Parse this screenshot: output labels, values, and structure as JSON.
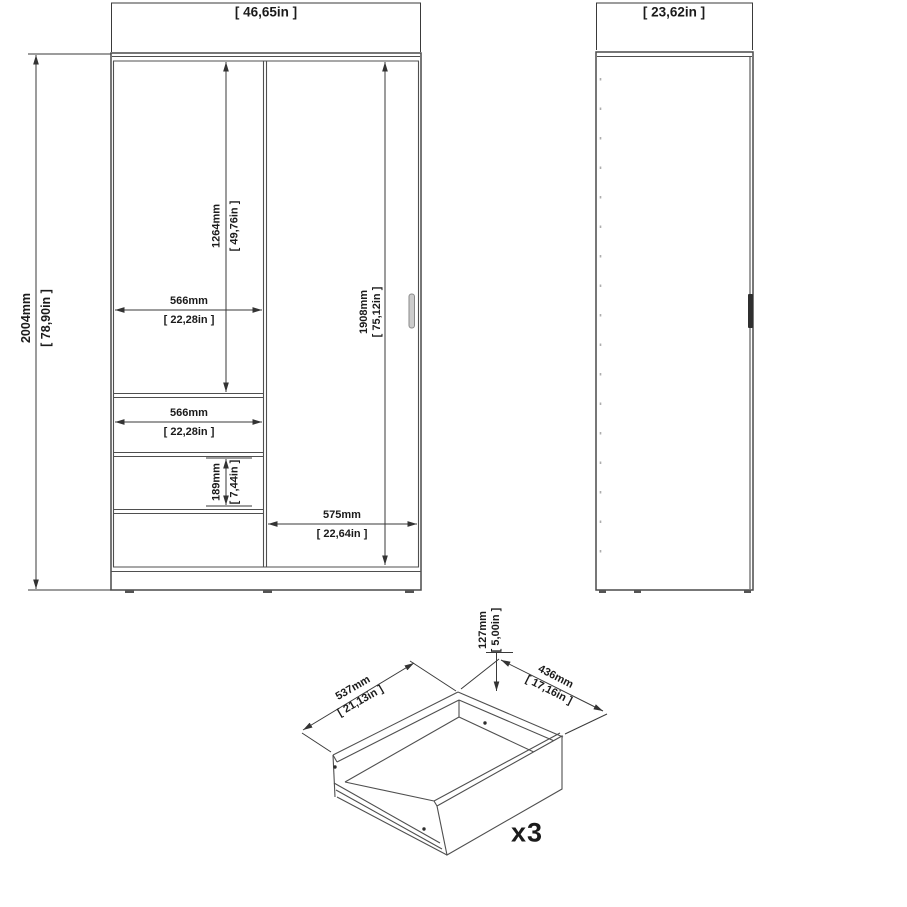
{
  "drawing_title": "wardrobe-dimension-drawing",
  "views": {
    "front": {
      "overall_width_in": "[ 46,65in ]",
      "overall_height": {
        "mm": "2004mm",
        "in": "[ 78,90in ]"
      },
      "left_compartment_height": {
        "mm": "1264mm",
        "in": "[ 49,76in ]"
      },
      "left_compartment_width": {
        "mm": "566mm",
        "in": "[ 22,28in ]"
      },
      "drawer_front_width": {
        "mm": "566mm",
        "in": "[ 22,28in ]"
      },
      "drawer_front_height": {
        "mm": "189mm",
        "in": "[ 7,44in ]"
      },
      "sliding_door_height": {
        "mm": "1908mm",
        "in": "[ 75,12in ]"
      },
      "sliding_door_width": {
        "mm": "575mm",
        "in": "[ 22,64in ]"
      }
    },
    "side": {
      "overall_depth_in": "[ 23,62in ]"
    },
    "drawer": {
      "width": {
        "mm": "537mm",
        "in": "[ 21,13in ]"
      },
      "depth": {
        "mm": "436mm",
        "in": "[ 17,16in ]"
      },
      "height": {
        "mm": "127mm",
        "in": "[ 5,00in ]"
      },
      "quantity": "x3"
    }
  },
  "colors": {
    "line": "#4a4a4a",
    "dimension_line": "#3a3a3a",
    "text": "#1b1b1b",
    "front_handle": "#cccccc",
    "side_handle": "#2f2f2f",
    "background": "#ffffff"
  }
}
